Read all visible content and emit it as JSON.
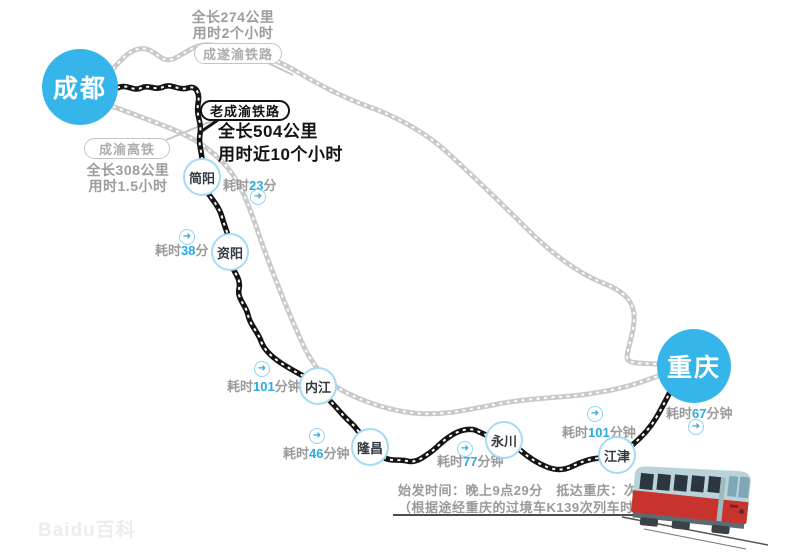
{
  "title": "成渝铁路线路示意图",
  "colors": {
    "city_blue": "#35b5e9",
    "accent_blue": "#29abe2",
    "station_border": "#a5dbf2",
    "route_gray": "#c9c9c9",
    "route_black": "#141414",
    "text_gray": "#9a9a9a",
    "train_red": "#c8332e"
  },
  "icons": {
    "transfer_arrow": "➜"
  },
  "watermark": "Baidu百科",
  "cities": {
    "chengdu": {
      "label": "成都"
    },
    "chongqing": {
      "label": "重庆"
    }
  },
  "stations": [
    {
      "label": "简阳"
    },
    {
      "label": "资阳"
    },
    {
      "label": "内江"
    },
    {
      "label": "隆昌"
    },
    {
      "label": "永川"
    },
    {
      "label": "江津"
    }
  ],
  "routes": {
    "chengsuyu": {
      "name": "成遂渝铁路",
      "stats": [
        "全长274公里",
        "用时2个小时"
      ]
    },
    "laochengyu": {
      "name": "老成渝铁路",
      "stats": [
        "全长504公里",
        "用时近10个小时"
      ]
    },
    "hsr": {
      "name": "成渝高铁",
      "stats": [
        "全长308公里",
        "用时1.5小时"
      ]
    }
  },
  "durations": [
    {
      "prefix": "耗时",
      "value": "23",
      "suffix": "分"
    },
    {
      "prefix": "耗时",
      "value": "38",
      "suffix": "分"
    },
    {
      "prefix": "耗时",
      "value": "101",
      "suffix": "分钟"
    },
    {
      "prefix": "耗时",
      "value": "46",
      "suffix": "分钟"
    },
    {
      "prefix": "耗时",
      "value": "77",
      "suffix": "分钟"
    },
    {
      "prefix": "耗时",
      "value": "101",
      "suffix": "分钟"
    },
    {
      "prefix": "耗时",
      "value": "67",
      "suffix": "分钟"
    }
  ],
  "schedule": {
    "line1": "始发时间：晚上9点29分　抵达重庆：次日6点57分",
    "line2": "（根据途经重庆的过境车K139次列车时间表）"
  }
}
